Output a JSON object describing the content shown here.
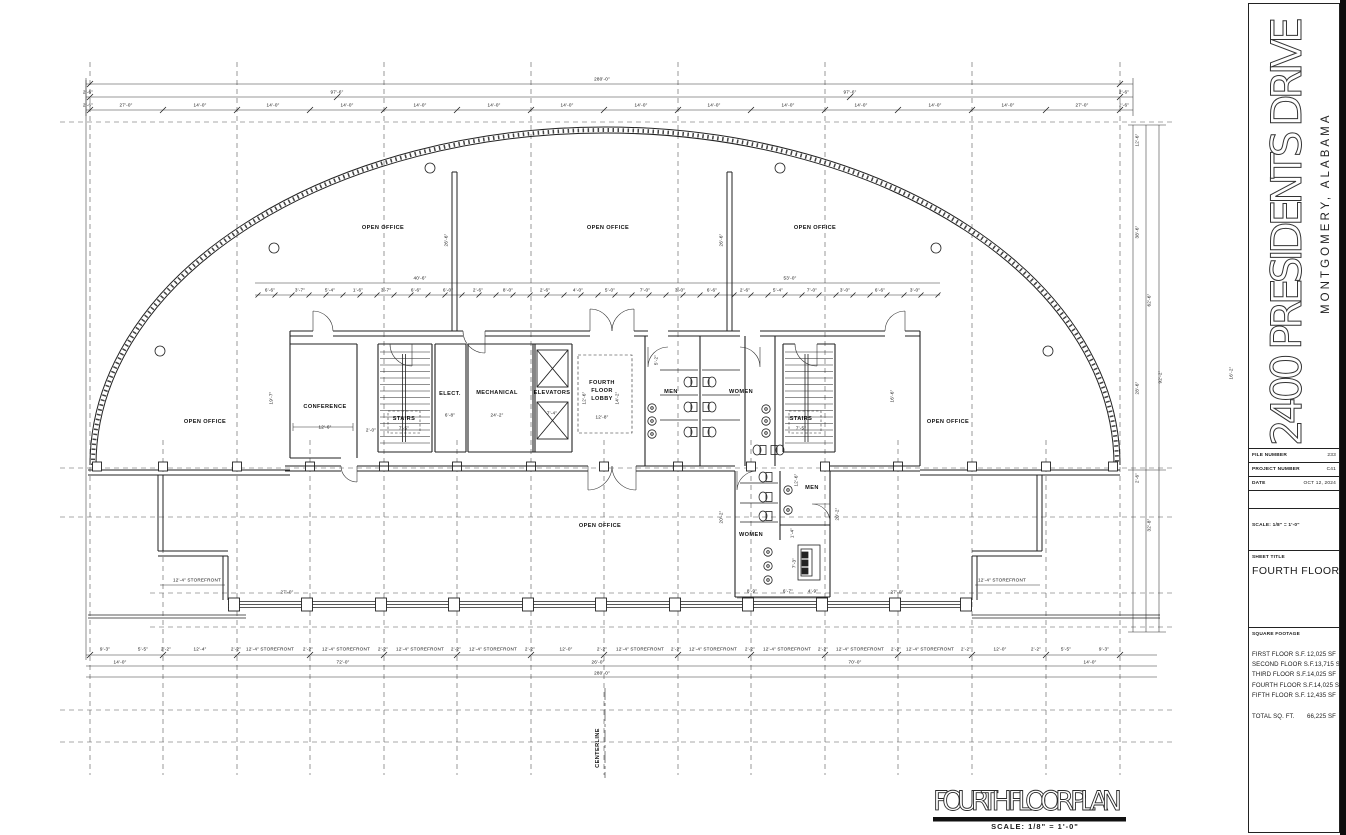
{
  "sheet": {
    "address": "2400 PRESIDENTS DRIVE",
    "city": "MONTGOMERY, ALABAMA",
    "file_number_label": "FILE NUMBER",
    "file_number": "233",
    "project_number_label": "PROJECT NUMBER",
    "project_number": "C41",
    "date_label": "DATE",
    "date_value": "OCT 12, 2024",
    "scale_label": "SCALE: 1/8\" = 1'-0\"",
    "sheet_title_label": "SHEET TITLE",
    "sheet_title": "FOURTH FLOOR PLAN"
  },
  "square_footage": {
    "header": "SQUARE FOOTAGE",
    "rows": [
      {
        "label": "FIRST FLOOR S.F.",
        "value": "12,025 SF"
      },
      {
        "label": "SECOND FLOOR S.F.",
        "value": "13,715 SF"
      },
      {
        "label": "THIRD FLOOR S.F.",
        "value": "14,025 SF"
      },
      {
        "label": "FOURTH FLOOR S.F.",
        "value": "14,025 SF"
      },
      {
        "label": "FIFTH FLOOR S.F.",
        "value": "12,435 SF"
      }
    ],
    "total_label": "TOTAL SQ. FT.",
    "total_value": "66,225 SF"
  },
  "drawing_title": {
    "text": "FOURTH FLOOR PLAN",
    "scale_note": "SCALE: 1/8\" = 1'-0\""
  },
  "plan": {
    "room_labels": [
      {
        "t": "OPEN OFFICE",
        "x": 383,
        "y": 229
      },
      {
        "t": "OPEN OFFICE",
        "x": 608,
        "y": 229
      },
      {
        "t": "OPEN OFFICE",
        "x": 815,
        "y": 229
      },
      {
        "t": "OPEN OFFICE",
        "x": 205,
        "y": 423
      },
      {
        "t": "OPEN OFFICE",
        "x": 948,
        "y": 423
      },
      {
        "t": "OPEN OFFICE",
        "x": 600,
        "y": 527
      },
      {
        "t": "CONFERENCE",
        "x": 325,
        "y": 408
      },
      {
        "t": "STAIRS",
        "x": 404,
        "y": 420
      },
      {
        "t": "ELECT.",
        "x": 450,
        "y": 395
      },
      {
        "t": "MECHANICAL",
        "x": 497,
        "y": 394
      },
      {
        "t": "ELEVATORS",
        "x": 552,
        "y": 394
      },
      {
        "t": "FOURTH",
        "x": 602,
        "y": 384
      },
      {
        "t": "FLOOR",
        "x": 602,
        "y": 392
      },
      {
        "t": "LOBBY",
        "x": 602,
        "y": 400
      },
      {
        "t": "MEN",
        "x": 671,
        "y": 393
      },
      {
        "t": "WOMEN",
        "x": 741,
        "y": 393
      },
      {
        "t": "STAIRS",
        "x": 801,
        "y": 420
      },
      {
        "t": "WOMEN",
        "x": 751,
        "y": 536
      },
      {
        "t": "MEN",
        "x": 812,
        "y": 489
      },
      {
        "t": "CENTERLINE",
        "x": 599,
        "y": 748,
        "r": -90
      }
    ],
    "dim_labels": [
      {
        "t": "280'-0\"",
        "x": 602,
        "y": 80
      },
      {
        "t": "97'-6\"",
        "x": 337,
        "y": 93
      },
      {
        "t": "97'-6\"",
        "x": 850,
        "y": 93
      },
      {
        "t": "2'-6\"",
        "x": 88,
        "y": 93
      },
      {
        "t": "2'-6\"",
        "x": 88,
        "y": 106
      },
      {
        "t": "2'-6\"",
        "x": 1124,
        "y": 93
      },
      {
        "t": "2'-6\"",
        "x": 1124,
        "y": 106
      },
      {
        "t": "27'-0\"",
        "x": 126,
        "y": 106
      },
      {
        "t": "14'-0\"",
        "x": 200,
        "y": 106
      },
      {
        "t": "14'-0\"",
        "x": 273,
        "y": 106
      },
      {
        "t": "14'-0\"",
        "x": 347,
        "y": 106
      },
      {
        "t": "14'-0\"",
        "x": 420,
        "y": 106
      },
      {
        "t": "14'-0\"",
        "x": 494,
        "y": 106
      },
      {
        "t": "14'-0\"",
        "x": 567,
        "y": 106
      },
      {
        "t": "14'-0\"",
        "x": 641,
        "y": 106
      },
      {
        "t": "14'-0\"",
        "x": 714,
        "y": 106
      },
      {
        "t": "14'-0\"",
        "x": 788,
        "y": 106
      },
      {
        "t": "14'-0\"",
        "x": 861,
        "y": 106
      },
      {
        "t": "14'-0\"",
        "x": 935,
        "y": 106
      },
      {
        "t": "14'-0\"",
        "x": 1008,
        "y": 106
      },
      {
        "t": "27'-0\"",
        "x": 1082,
        "y": 106
      },
      {
        "t": "40'-6\"",
        "x": 420,
        "y": 279
      },
      {
        "t": "53'-0\"",
        "x": 790,
        "y": 279
      },
      {
        "t": "6'-6\"",
        "x": 270,
        "y": 291
      },
      {
        "t": "3'-7\"",
        "x": 300,
        "y": 291
      },
      {
        "t": "5'-4\"",
        "x": 330,
        "y": 291
      },
      {
        "t": "1'-6\"",
        "x": 358,
        "y": 291
      },
      {
        "t": "3'-7\"",
        "x": 386,
        "y": 291
      },
      {
        "t": "6'-6\"",
        "x": 416,
        "y": 291
      },
      {
        "t": "6'-0\"",
        "x": 448,
        "y": 291
      },
      {
        "t": "2'-6\"",
        "x": 478,
        "y": 291
      },
      {
        "t": "8'-0\"",
        "x": 508,
        "y": 291
      },
      {
        "t": "2'-6\"",
        "x": 545,
        "y": 291
      },
      {
        "t": "4'-0\"",
        "x": 578,
        "y": 291
      },
      {
        "t": "5'-0\"",
        "x": 610,
        "y": 291
      },
      {
        "t": "7'-0\"",
        "x": 645,
        "y": 291
      },
      {
        "t": "3'-0\"",
        "x": 680,
        "y": 291
      },
      {
        "t": "6'-6\"",
        "x": 712,
        "y": 291
      },
      {
        "t": "2'-6\"",
        "x": 745,
        "y": 291
      },
      {
        "t": "5'-4\"",
        "x": 778,
        "y": 291
      },
      {
        "t": "7'-0\"",
        "x": 812,
        "y": 291
      },
      {
        "t": "3'-0\"",
        "x": 845,
        "y": 291
      },
      {
        "t": "6'-6\"",
        "x": 880,
        "y": 291
      },
      {
        "t": "3'-0\"",
        "x": 915,
        "y": 291
      },
      {
        "t": "26'-6\"",
        "x": 447,
        "y": 240,
        "r": -90
      },
      {
        "t": "26'-6\"",
        "x": 722,
        "y": 240,
        "r": -90
      },
      {
        "t": "19'-7\"",
        "x": 272,
        "y": 398,
        "r": -90
      },
      {
        "t": "12'-6\"",
        "x": 325,
        "y": 428
      },
      {
        "t": "2'-0\"",
        "x": 371,
        "y": 431
      },
      {
        "t": "7'-5\"",
        "x": 404,
        "y": 429
      },
      {
        "t": "6'-8\"",
        "x": 450,
        "y": 416
      },
      {
        "t": "24'-2\"",
        "x": 497,
        "y": 416
      },
      {
        "t": "7'-4\"",
        "x": 552,
        "y": 414
      },
      {
        "t": "12'-6\"",
        "x": 585,
        "y": 398,
        "r": -90
      },
      {
        "t": "14'-2\"",
        "x": 618,
        "y": 398,
        "r": -90
      },
      {
        "t": "12'-8\"",
        "x": 602,
        "y": 418
      },
      {
        "t": "5'-2\"",
        "x": 657,
        "y": 360,
        "r": -90
      },
      {
        "t": "16'-6\"",
        "x": 893,
        "y": 396,
        "r": -90
      },
      {
        "t": "7'-5\"",
        "x": 801,
        "y": 429
      },
      {
        "t": "20'-2\"",
        "x": 722,
        "y": 517,
        "r": -90
      },
      {
        "t": "20'-2\"",
        "x": 838,
        "y": 514,
        "r": -90
      },
      {
        "t": "12'-6\"",
        "x": 797,
        "y": 480,
        "r": -90
      },
      {
        "t": "1'-4\"",
        "x": 793,
        "y": 533,
        "r": -90
      },
      {
        "t": "7'-3\"",
        "x": 795,
        "y": 563,
        "r": -90
      },
      {
        "t": "8'-9\"",
        "x": 752,
        "y": 592
      },
      {
        "t": "6'-7\"",
        "x": 788,
        "y": 592
      },
      {
        "t": "4'-9\"",
        "x": 813,
        "y": 592
      },
      {
        "t": "12'-4\" STOREFRONT",
        "x": 197,
        "y": 581
      },
      {
        "t": "12'-4\" STOREFRONT",
        "x": 1002,
        "y": 581
      },
      {
        "t": "27'-0\"",
        "x": 287,
        "y": 593
      },
      {
        "t": "27'-0\"",
        "x": 897,
        "y": 593
      },
      {
        "t": "9'-3\"",
        "x": 105,
        "y": 650
      },
      {
        "t": "5'-5\"",
        "x": 143,
        "y": 650
      },
      {
        "t": "2'-2\"",
        "x": 166,
        "y": 650
      },
      {
        "t": "12'-4\"",
        "x": 200,
        "y": 650
      },
      {
        "t": "2'-2\"",
        "x": 236,
        "y": 650
      },
      {
        "t": "12'-4\" STOREFRONT",
        "x": 270,
        "y": 650
      },
      {
        "t": "2'-2\"",
        "x": 308,
        "y": 650
      },
      {
        "t": "12'-4\" STOREFRONT",
        "x": 346,
        "y": 650
      },
      {
        "t": "2'-2\"",
        "x": 383,
        "y": 650
      },
      {
        "t": "12'-4\" STOREFRONT",
        "x": 420,
        "y": 650
      },
      {
        "t": "2'-2\"",
        "x": 456,
        "y": 650
      },
      {
        "t": "12'-4\" STOREFRONT",
        "x": 493,
        "y": 650
      },
      {
        "t": "2'-2\"",
        "x": 530,
        "y": 650
      },
      {
        "t": "12'-0\"",
        "x": 566,
        "y": 650
      },
      {
        "t": "2'-2\"",
        "x": 602,
        "y": 650
      },
      {
        "t": "12'-4\" STOREFRONT",
        "x": 640,
        "y": 650
      },
      {
        "t": "2'-2\"",
        "x": 676,
        "y": 650
      },
      {
        "t": "12'-4\" STOREFRONT",
        "x": 713,
        "y": 650
      },
      {
        "t": "2'-2\"",
        "x": 750,
        "y": 650
      },
      {
        "t": "12'-4\" STOREFRONT",
        "x": 787,
        "y": 650
      },
      {
        "t": "2'-2\"",
        "x": 823,
        "y": 650
      },
      {
        "t": "12'-4\" STOREFRONT",
        "x": 860,
        "y": 650
      },
      {
        "t": "2'-2\"",
        "x": 896,
        "y": 650
      },
      {
        "t": "12'-4\" STOREFRONT",
        "x": 930,
        "y": 650
      },
      {
        "t": "2'-2\"",
        "x": 966,
        "y": 650
      },
      {
        "t": "12'-0\"",
        "x": 1000,
        "y": 650
      },
      {
        "t": "2'-2\"",
        "x": 1036,
        "y": 650
      },
      {
        "t": "5'-5\"",
        "x": 1066,
        "y": 650
      },
      {
        "t": "9'-3\"",
        "x": 1104,
        "y": 650
      },
      {
        "t": "14'-0\"",
        "x": 120,
        "y": 663
      },
      {
        "t": "72'-0\"",
        "x": 343,
        "y": 663
      },
      {
        "t": "26'-0\"",
        "x": 598,
        "y": 663
      },
      {
        "t": "70'-0\"",
        "x": 855,
        "y": 663
      },
      {
        "t": "14'-0\"",
        "x": 1090,
        "y": 663
      },
      {
        "t": "280'-0\"",
        "x": 602,
        "y": 674
      },
      {
        "t": "12'-6\"",
        "x": 1138,
        "y": 140,
        "r": -90
      },
      {
        "t": "38'-6\"",
        "x": 1138,
        "y": 232,
        "r": -90
      },
      {
        "t": "62'-6\"",
        "x": 1150,
        "y": 300,
        "r": -90
      },
      {
        "t": "92'-2\"",
        "x": 1161,
        "y": 377,
        "r": -90
      },
      {
        "t": "28'-6\"",
        "x": 1138,
        "y": 388,
        "r": -90
      },
      {
        "t": "16'-2\"",
        "x": 1232,
        "y": 373,
        "r": -90
      },
      {
        "t": "2'-6\"",
        "x": 1138,
        "y": 478,
        "r": -90
      },
      {
        "t": "32'-8\"",
        "x": 1150,
        "y": 525,
        "r": -90
      }
    ]
  }
}
